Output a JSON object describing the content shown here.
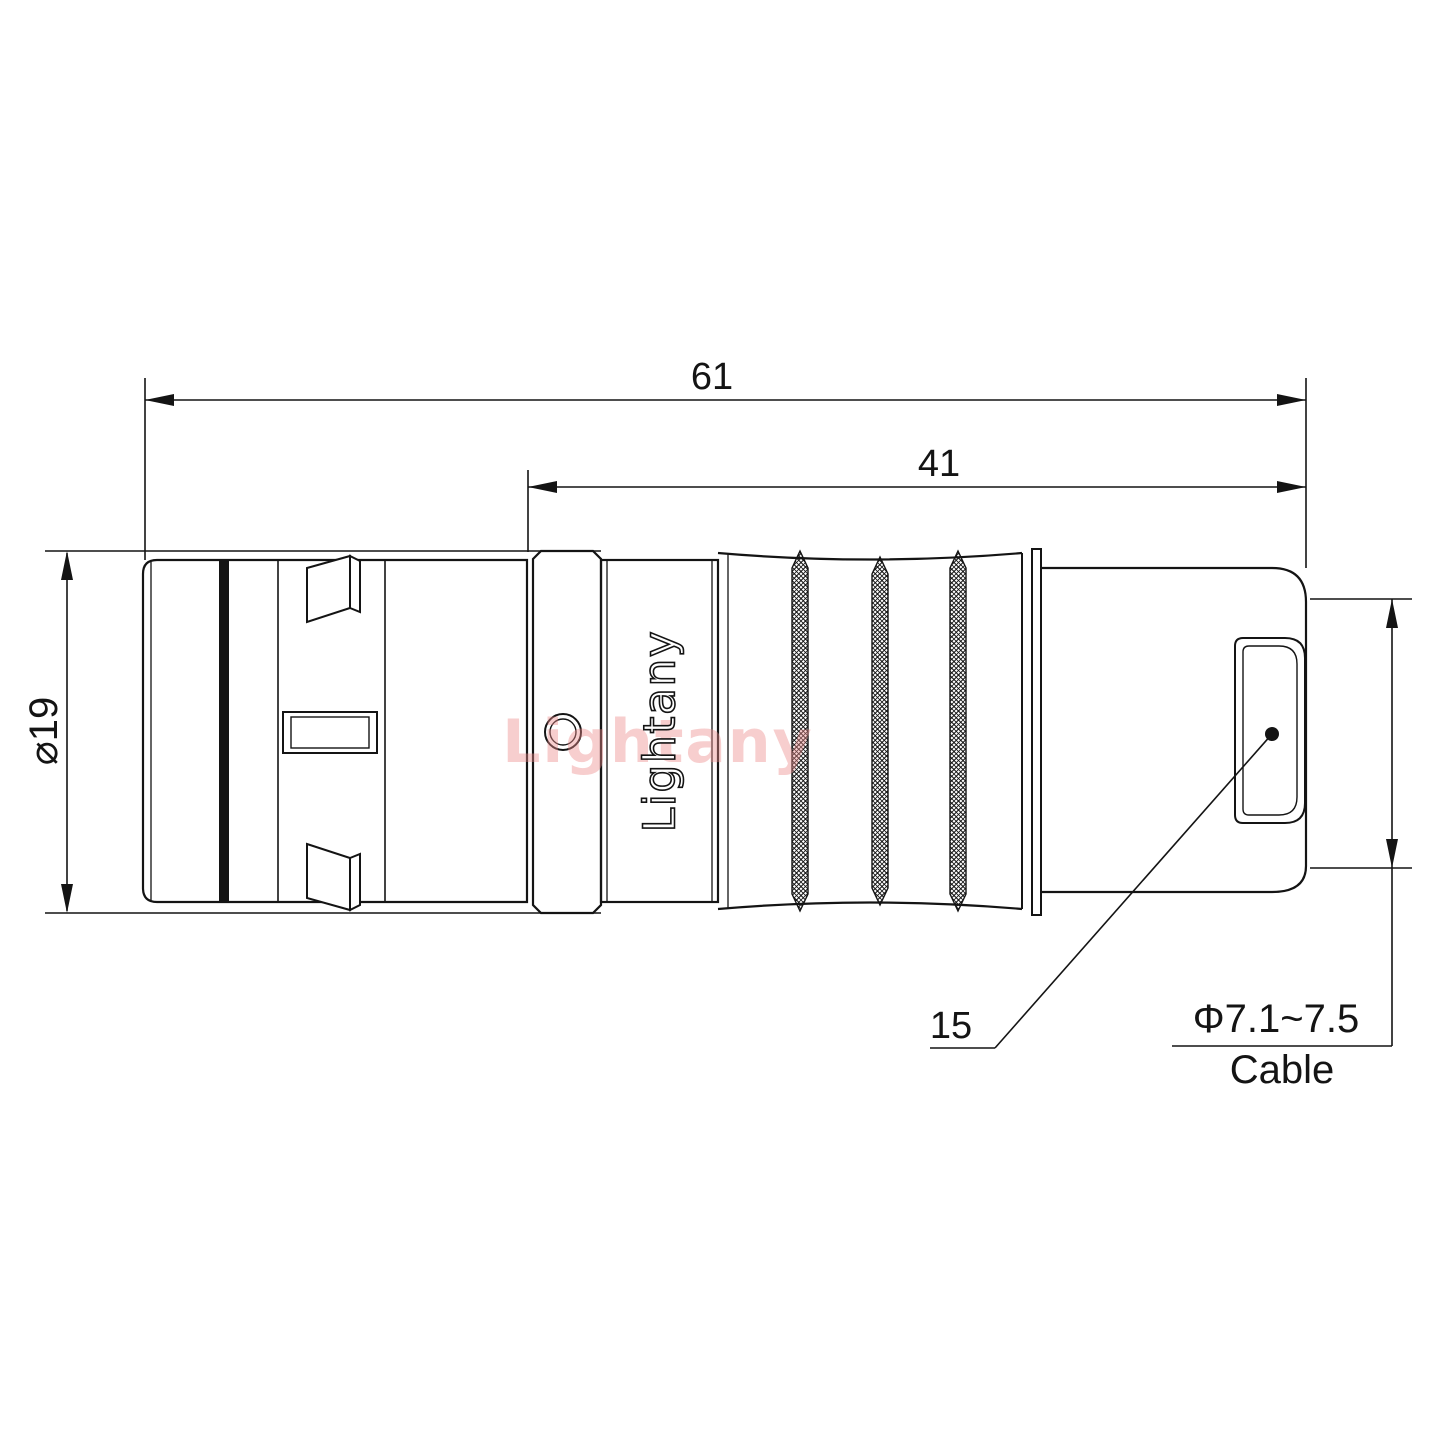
{
  "drawing": {
    "watermark": "Lightany",
    "part": {
      "brand_label": "Lightany"
    },
    "dimensions": {
      "overall_length": "61",
      "rear_length": "41",
      "outer_diameter": "⌀19",
      "backnut_size": "15",
      "cable_diameter_range": "Φ7.1~7.5",
      "cable_label": "Cable"
    },
    "colors": {
      "line": "#141414",
      "background": "#ffffff",
      "watermark_pink": "#eb8a8a"
    }
  }
}
